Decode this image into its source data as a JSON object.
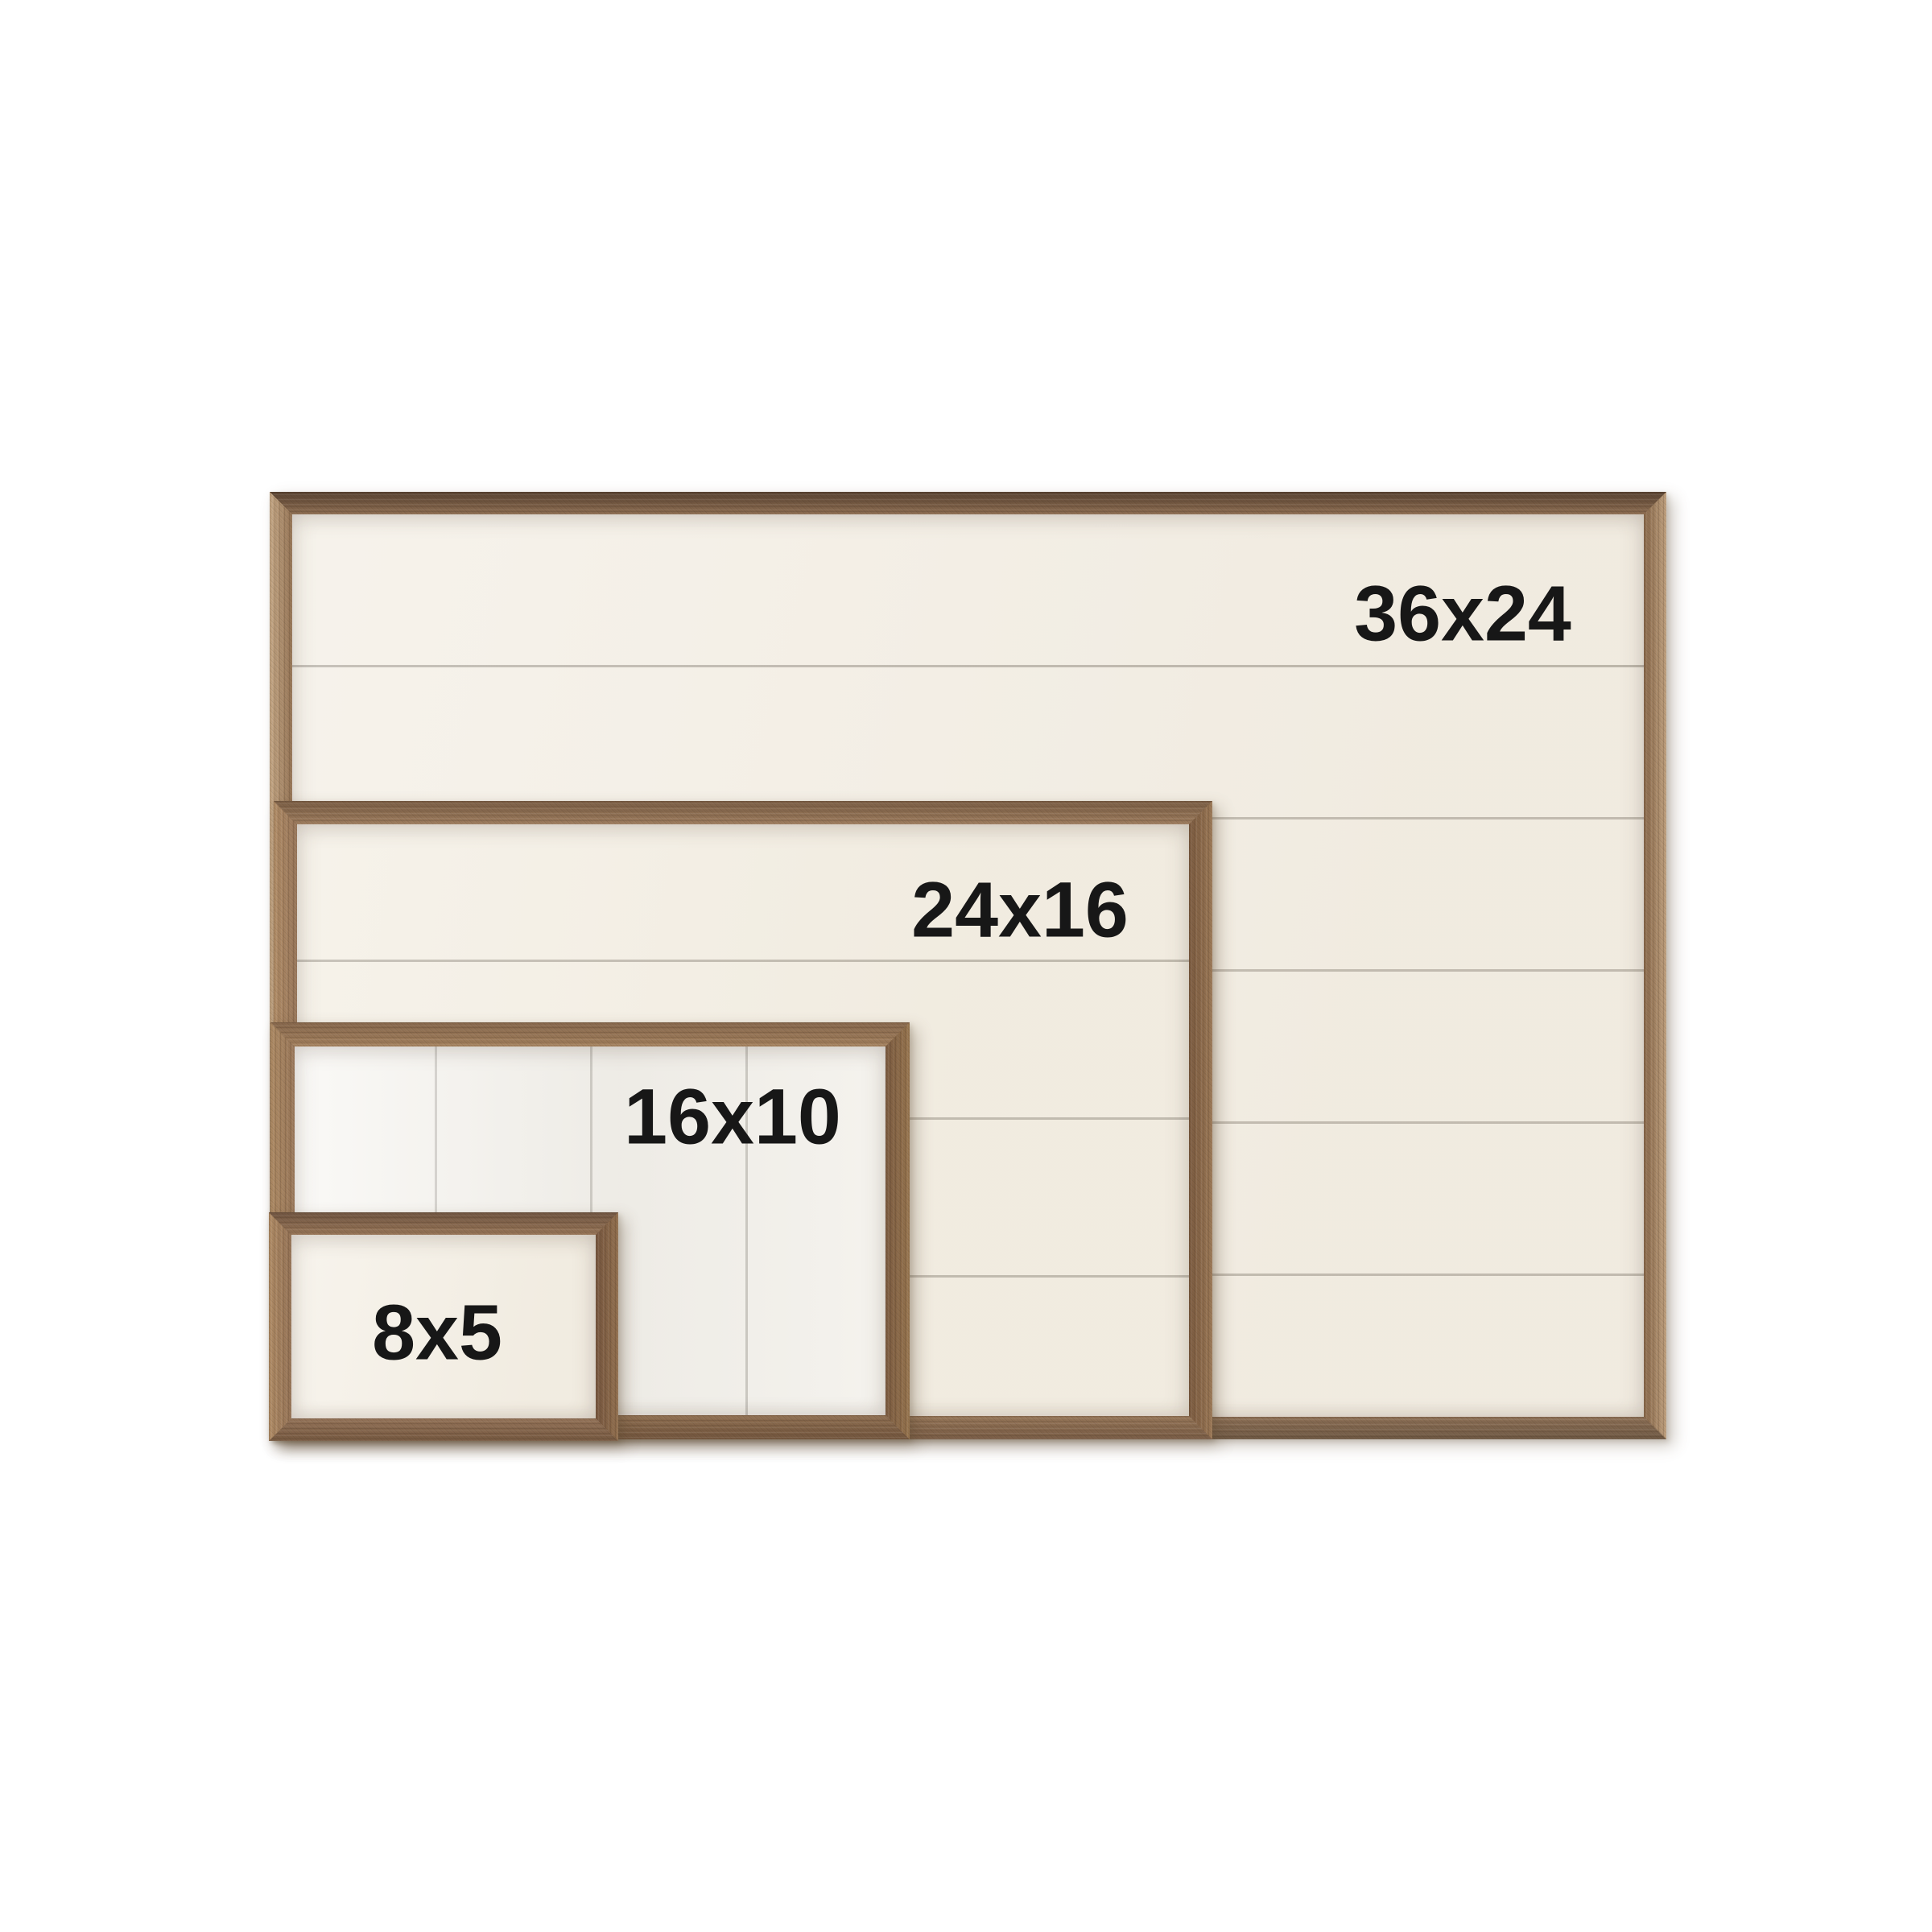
{
  "photo": {
    "background_color": "#ffffff",
    "wood_frame_color": "#9a785c",
    "panel_color": "#f3eee4",
    "label_color": "#171717"
  },
  "boards": [
    {
      "label": "36x24",
      "width_in": 36,
      "height_in": 24,
      "planks": "horizontal"
    },
    {
      "label": "24x16",
      "width_in": 24,
      "height_in": 16,
      "planks": "horizontal"
    },
    {
      "label": "16x10",
      "width_in": 16,
      "height_in": 10,
      "planks": "vertical"
    },
    {
      "label": "8x5",
      "width_in": 8,
      "height_in": 5,
      "planks": "none"
    }
  ]
}
